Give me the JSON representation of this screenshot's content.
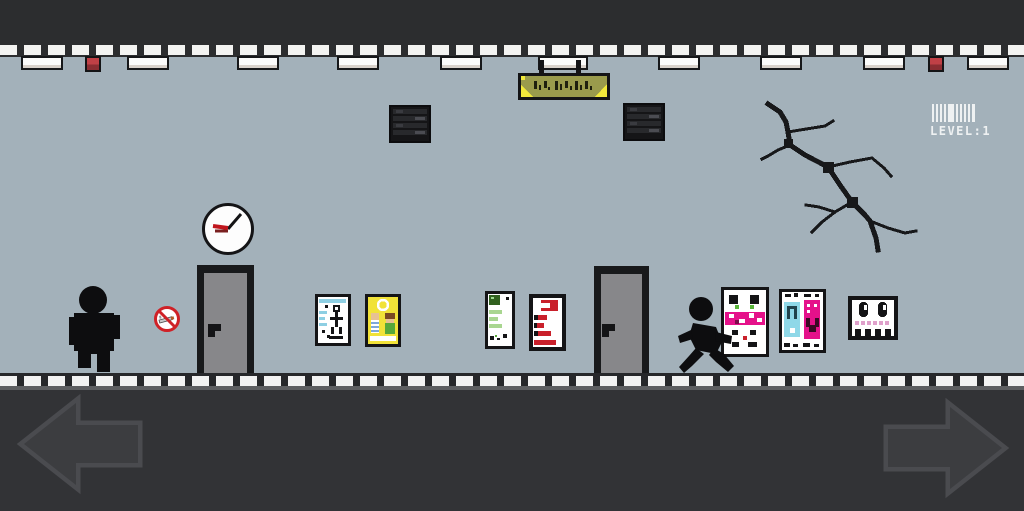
{
  "hud": {
    "level_label": "LEVEL:1",
    "barcode_icon": "barcode-icon"
  },
  "controls": {
    "left_arrow_icon": "left-arrow-icon",
    "right_arrow_icon": "right-arrow-icon"
  },
  "scene": {
    "wall_color": "#a3b1ba",
    "ceiling_bar_color": "#2c2d2f",
    "floor_area_color": "#323336",
    "alarm_color": "#b23a3f",
    "sign_colors": {
      "panel": "#9a9b4c",
      "corner": "#f2e93b"
    },
    "no_smoking_color": "#cf2127",
    "poster_colors": {
      "cyan": "#8ecfe3",
      "yellow": "#f1e238",
      "green_dark": "#31611f",
      "green_light": "#a9d690",
      "red": "#c9202b",
      "magenta": "#e5118a",
      "pink": "#dfa0cb"
    },
    "objects": [
      "ceiling-lights",
      "fire-alarms",
      "air-vents",
      "hanging-sign",
      "wall-crack",
      "wall-clock",
      "no-smoking-sign",
      "door-left",
      "door-right",
      "poster-stick-figure",
      "poster-sunny",
      "poster-green-chart",
      "poster-red-list",
      "vending-machine-face",
      "vending-machine-drinks",
      "skull-poster",
      "standing-character",
      "running-character"
    ]
  }
}
